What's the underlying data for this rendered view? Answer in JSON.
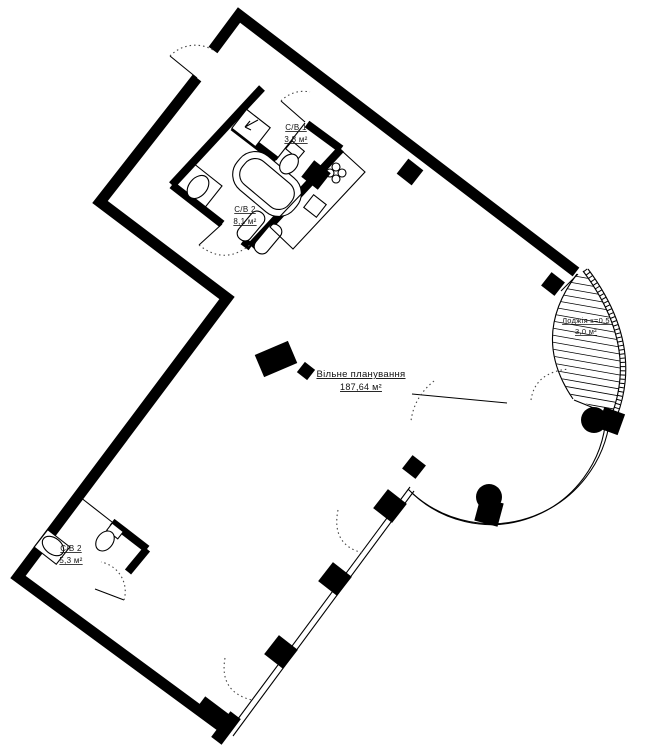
{
  "plan": {
    "free_planning": {
      "label": "Вільне планування",
      "area": "187,64 м²"
    },
    "rooms": [
      {
        "id": "cb1-upper",
        "name": "С/В 1",
        "area": "3,8 м²"
      },
      {
        "id": "cb2-upper",
        "name": "С/В 2",
        "area": "8,1 м²"
      },
      {
        "id": "cb2-lower",
        "name": "С/В 2",
        "area": "5,3 м²"
      },
      {
        "id": "loggia",
        "name": "Лоджія к=0,5",
        "area": "3,0 м²"
      }
    ],
    "colors": {
      "walls": "#000000",
      "background": "#ffffff",
      "text": "#111111"
    }
  }
}
